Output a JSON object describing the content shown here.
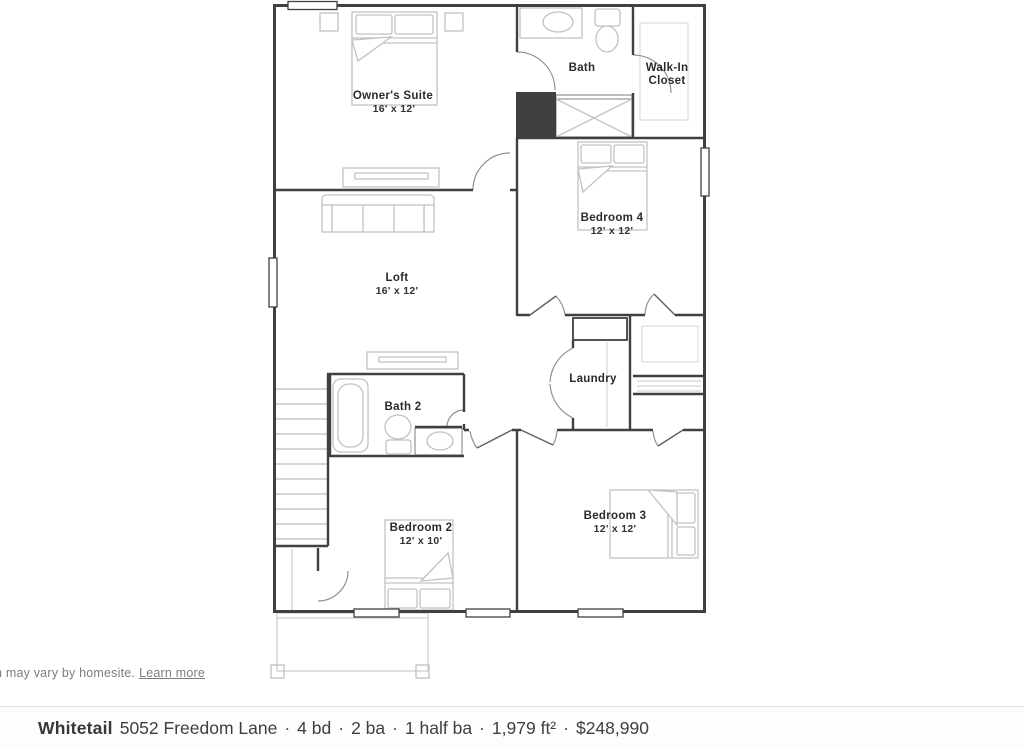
{
  "floor_plan": {
    "rooms": {
      "owner_suite": {
        "name": "Owner's Suite",
        "dims": "16' x 12'"
      },
      "bath": {
        "name": "Bath"
      },
      "walk_in_closet": {
        "line1": "Walk-In",
        "line2": "Closet"
      },
      "bedroom4": {
        "name": "Bedroom 4",
        "dims": "12' x 12'"
      },
      "loft": {
        "name": "Loft",
        "dims": "16' x 12'"
      },
      "laundry": {
        "name": "Laundry"
      },
      "bath2": {
        "name": "Bath 2"
      },
      "bedroom2": {
        "name": "Bedroom 2",
        "dims": "12' x 10'"
      },
      "bedroom3": {
        "name": "Bedroom 3",
        "dims": "12' x 12'"
      }
    },
    "colors": {
      "wall": "#404040",
      "furniture": "#c2c2c2",
      "shelving": "#dcdcdc",
      "door_swing": "#8f8f8f",
      "porch": "#cfcfcf"
    }
  },
  "disclaimer": {
    "fragment": "n",
    "text": "may vary by homesite.",
    "link_label": "Learn more"
  },
  "listing_bar": {
    "plan_name": "Whitetail",
    "address": "5052 Freedom Lane",
    "separator": "·",
    "beds": "4 bd",
    "baths": "2 ba",
    "half_baths": "1 half ba",
    "area": "1,979 ft²",
    "price": "$248,990"
  }
}
